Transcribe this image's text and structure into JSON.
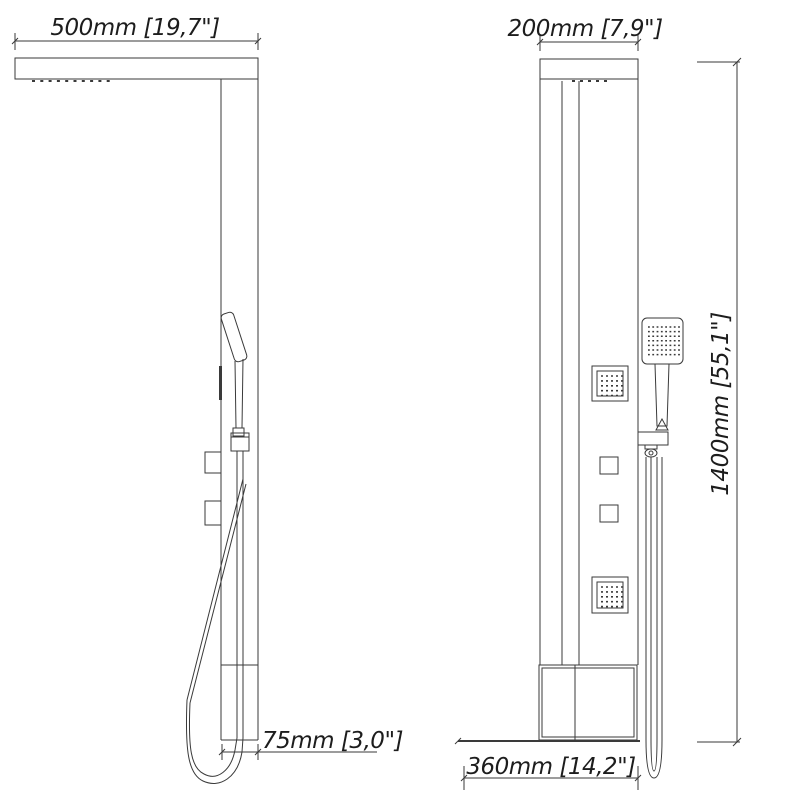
{
  "colors": {
    "line": "#3a3a3a",
    "text": "#1d1d1d",
    "background": "#ffffff"
  },
  "drawing_type": "shower panel dimensional drawing, two orthographic views",
  "views": {
    "side": {
      "dims": {
        "arm_width": "500mm [19,7\"]",
        "panel_depth": "75mm [3,0\"]"
      }
    },
    "front": {
      "dims": {
        "panel_width": "200mm [7,9\"]",
        "panel_height": "1400mm [55,1\"]",
        "base_width": "360mm [14,2\"]"
      }
    }
  }
}
